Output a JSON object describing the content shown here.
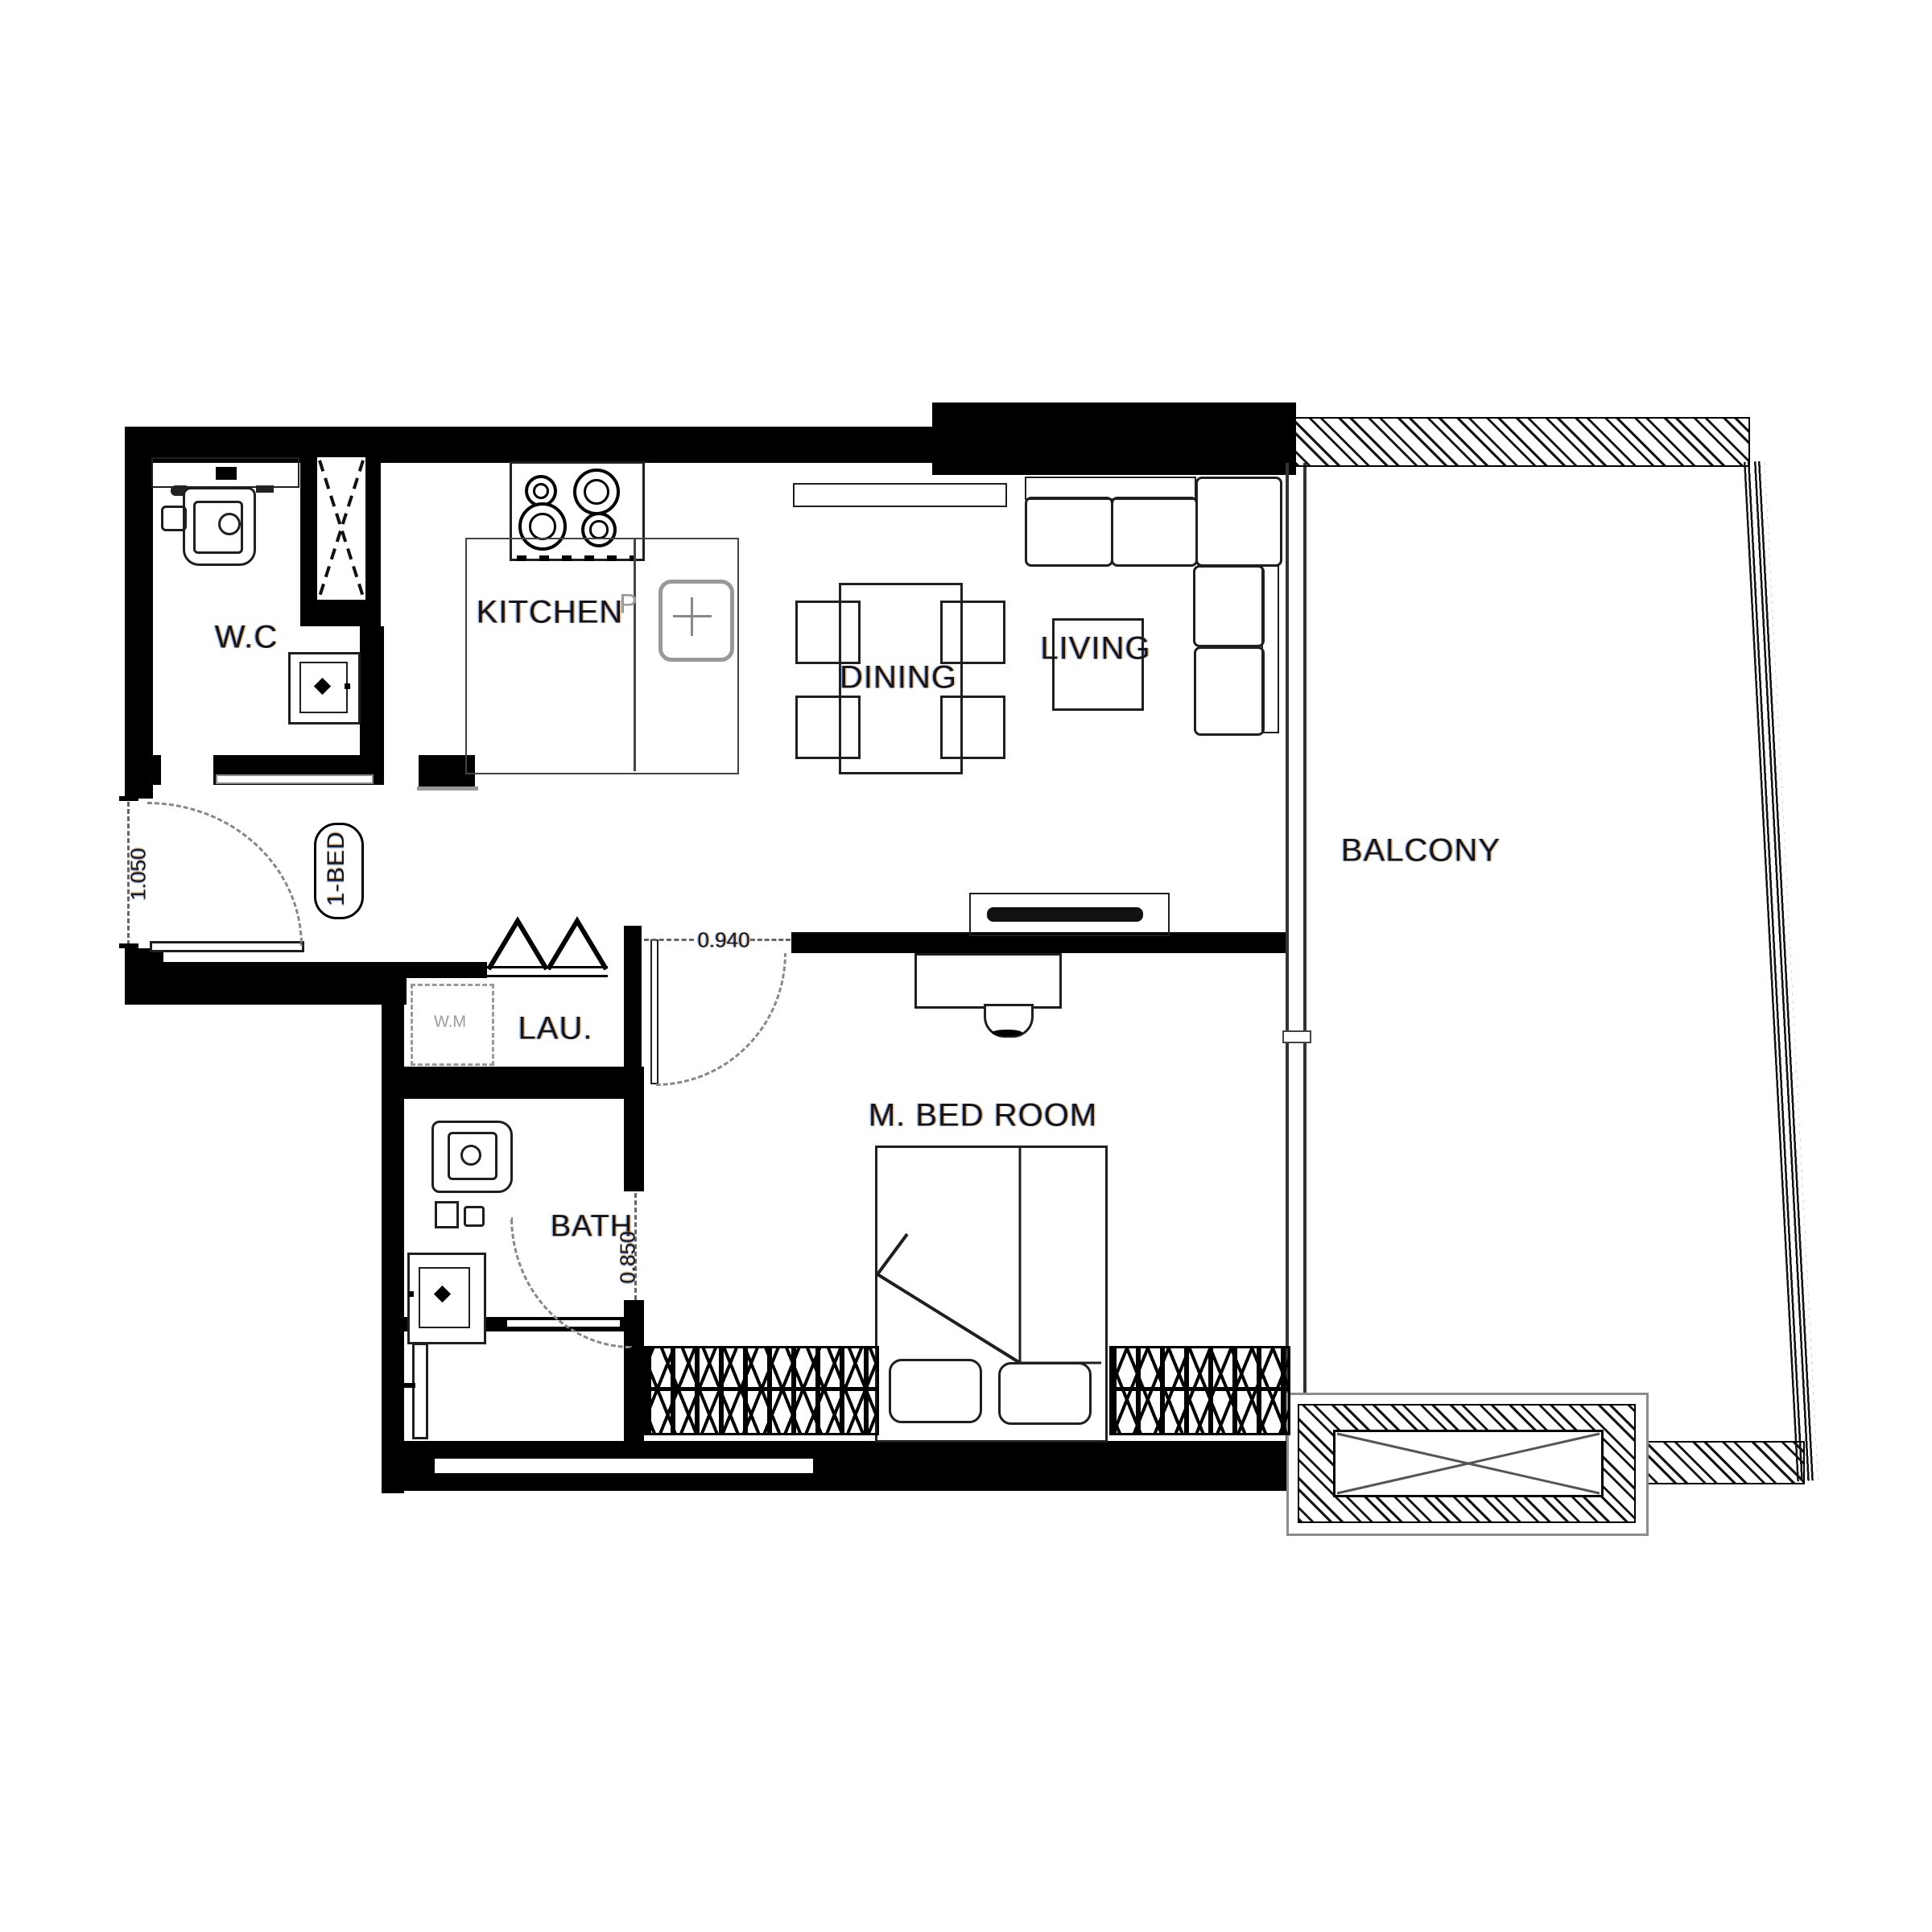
{
  "plan": {
    "type": "apartment-floor-plan",
    "unit_badge": "1-BED",
    "rooms": {
      "wc": "W.C",
      "kitchen": "KITCHEN",
      "dining": "DINING",
      "living": "LIVING",
      "balcony": "BALCONY",
      "laundry": "LAU.",
      "bath": "BATH",
      "master_bedroom": "M. BED ROOM"
    },
    "labels": {
      "washing_machine": "W.M",
      "kitchen_marker": "P"
    },
    "dimensions": {
      "entry_door": "1.050",
      "bedroom_door": "0.940",
      "bath_door": "0.850"
    },
    "colors": {
      "wall": "#000000",
      "furniture_line": "#1f1f1f",
      "light_line": "#8c8c8c",
      "label_text": "#15151c",
      "background": "#ffffff"
    }
  }
}
